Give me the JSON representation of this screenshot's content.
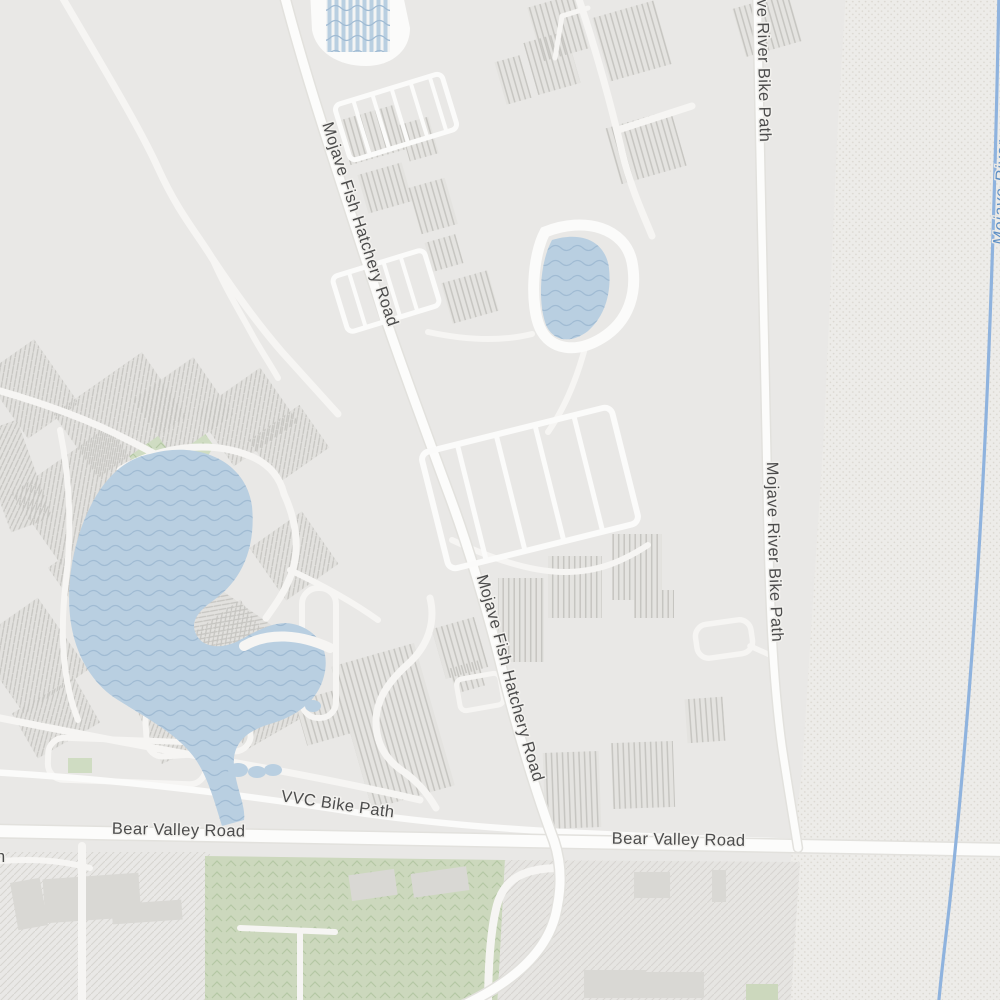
{
  "map": {
    "labels": {
      "mojave_fish_hatchery_road": "Mojave Fish Hatchery Road",
      "mojave_river_bike_path": "Mojave River Bike Path",
      "vvc_bike_path": "VVC Bike Path",
      "bear_valley_road": "Bear Valley Road",
      "river_name": "Mojave River",
      "left_edge_clipped_label": "n"
    },
    "features": {
      "lake": "campus-lake",
      "pond": "hatchery-pond",
      "raceways": "fish-hatchery-raceways",
      "wash": "mojave-riverbed-wash",
      "river": "mojave-river-waterline"
    },
    "colors": {
      "background": "#e9e8e6",
      "road_fill": "#fcfcfb",
      "road_minor": "#f6f5f3",
      "road_casing": "#dededa",
      "water_fill": "#b9cfe1",
      "water_wave": "#a0bbd3",
      "river_line": "#8fb3de",
      "water_label": "#5d8fc5",
      "park_green": "#cfdcc2",
      "field_green": "#ccd8bd",
      "green_texture": "#b4c7a4",
      "building_fill": "#e2e1de",
      "building_hatch": "#c6c5c1",
      "wash_background": "#edece9",
      "wash_dot": "#dbd8d1",
      "field_hatch": "#d7d5d1",
      "label_text": "#4c4c4c"
    }
  }
}
